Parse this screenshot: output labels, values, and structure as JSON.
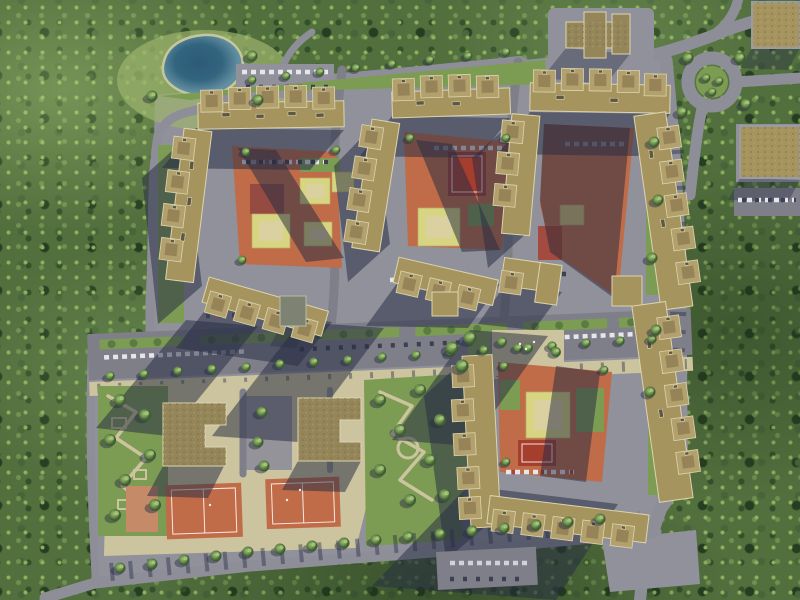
{
  "meta": {
    "title": "Aerial 3D render of a residential complex",
    "image_type": "aerial-top-down-render",
    "time_of_day": "daytime, low sun",
    "shadow_direction": "southwest (long shadows cast down-left)"
  },
  "palette": {
    "forestBase": "#526f3e",
    "lawn": "#7c9b53",
    "sand": "#cbc49e",
    "road": "#8e8e98",
    "roadD": "#7f7f8a",
    "estate": "#90919b",
    "shadow": "#272c44",
    "pond": "#33657f",
    "pondEdge": "#c6c79c",
    "roof1": "#a6945f",
    "roof2": "#b2a16d",
    "roofDark": "#7f6e47",
    "parapet": "#dcd4ae",
    "schoolRoof": "#95865a",
    "courtOrange": "#c06c48",
    "courtRed": "#a63e2e",
    "playYellow": "#d8d582",
    "playSand": "#dbd1a0",
    "carLight": "#e6e6ec",
    "carDark": "#3c4052",
    "carRed": "#b04038"
  },
  "regions": [
    {
      "name": "forest",
      "description": "dense green tree canopy surrounding the estate on left, top, right and bottom"
    },
    {
      "name": "lake",
      "description": "small blue pond with sandy shore, upper left"
    },
    {
      "name": "residential-block-1",
      "description": "U-shaped segmented apartment block, upper left, orange courtyard with playgrounds"
    },
    {
      "name": "residential-block-2",
      "description": "U-shaped apartment block, upper middle, courtyard with red sport court and playground"
    },
    {
      "name": "residential-block-3",
      "description": "large U-shaped apartment block, upper right, courtyard mostly in shadow"
    },
    {
      "name": "residential-block-4",
      "description": "large apartment block, lower right, courtyard with yellow playground and red court"
    },
    {
      "name": "kindergarten-building",
      "description": "cross-shaped brown-roofed building at top centre"
    },
    {
      "name": "commercial-building-1",
      "description": "flat brown-roofed building, top right corner"
    },
    {
      "name": "commercial-building-2",
      "description": "flat brown-roofed building with parking, right edge"
    },
    {
      "name": "school-building-1",
      "description": "C-shaped brown roof, lower centre-left"
    },
    {
      "name": "school-building-2",
      "description": "C-shaped brown roof, lower centre"
    },
    {
      "name": "sports-field-small",
      "description": "small orange court, bottom left"
    },
    {
      "name": "sports-field-1",
      "description": "orange field with white markings, bottom centre-left"
    },
    {
      "name": "sports-field-2",
      "description": "orange field with white markings, bottom centre"
    },
    {
      "name": "boulevard",
      "description": "wide avenue with green parking medians, tree rows and sidewalk crossing the estate"
    },
    {
      "name": "ring-road",
      "description": "roundabout with green centre, top right"
    },
    {
      "name": "gardens",
      "description": "landscaped gardens with winding sandy paths, left and centre"
    },
    {
      "name": "parking-lots",
      "description": "rows of parked cars near pond, courtyards, bottom and right"
    }
  ],
  "counts": {
    "residential_blocks": 4,
    "schools": 2,
    "sports_fields": 3,
    "ponds": 1,
    "roundabouts": 1
  }
}
